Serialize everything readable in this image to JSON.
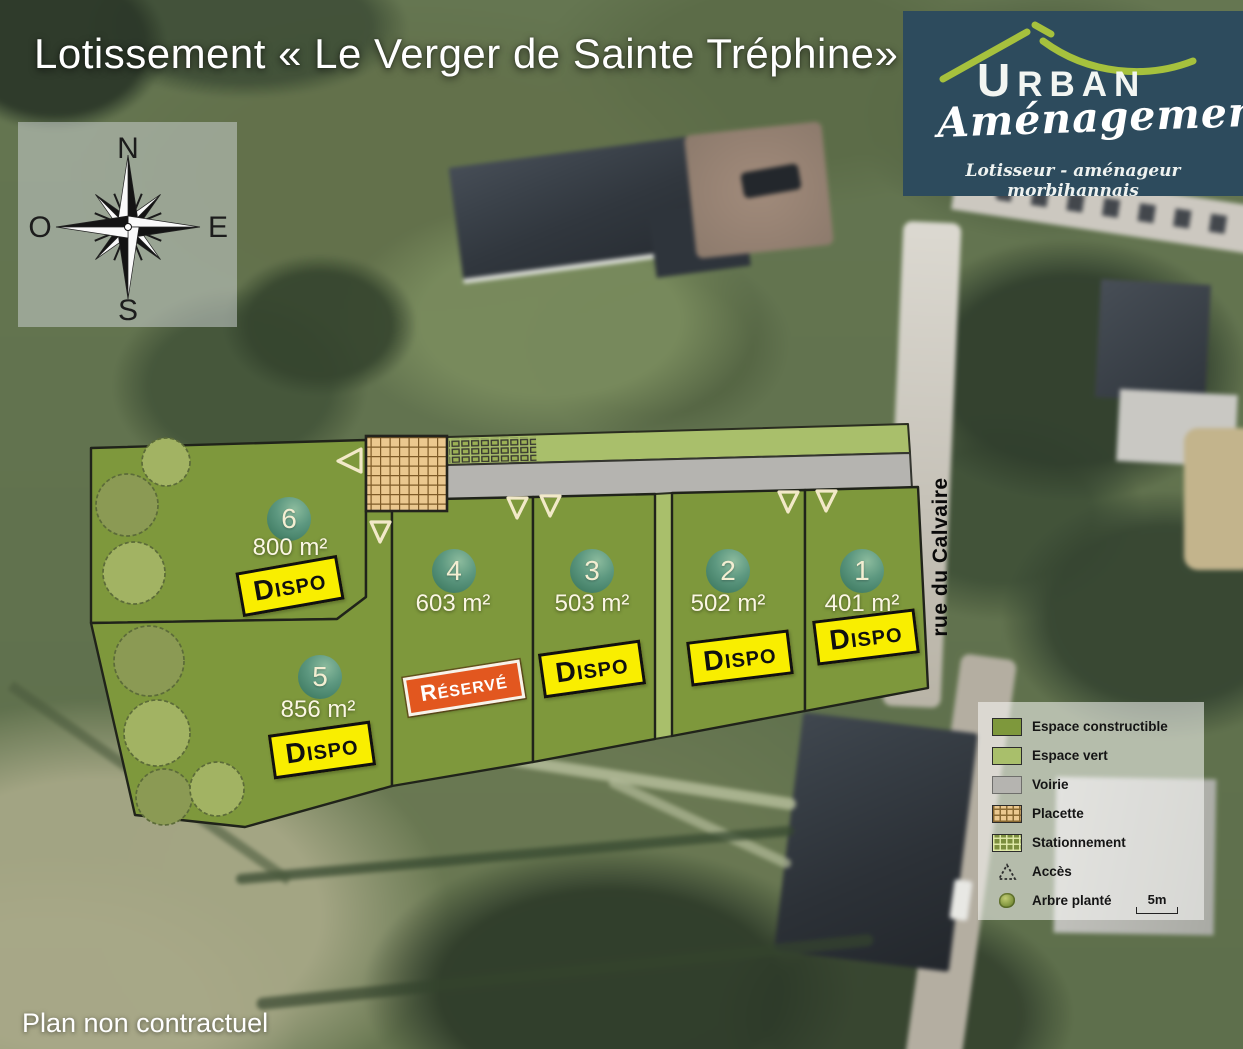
{
  "title": "Lotissement « Le Verger de Sainte Tréphine»",
  "footer": "Plan non contractuel",
  "logo": {
    "brand": "URBAN",
    "brand_sub": "Aménagement",
    "tagline": "Lotisseur - aménageur morbihannais"
  },
  "compass": {
    "n": "N",
    "s": "S",
    "e": "E",
    "w": "O"
  },
  "street": {
    "name": "rue du Calvaire"
  },
  "plots": [
    {
      "number": "1",
      "area": "401 m²",
      "status": "DISPO",
      "status_type": "available"
    },
    {
      "number": "2",
      "area": "502 m²",
      "status": "DISPO",
      "status_type": "available"
    },
    {
      "number": "3",
      "area": "503 m²",
      "status": "DISPO",
      "status_type": "available"
    },
    {
      "number": "4",
      "area": "603 m²",
      "status": "RÉSERVÉ",
      "status_type": "reserved"
    },
    {
      "number": "5",
      "area": "856 m²",
      "status": "DISPO",
      "status_type": "available"
    },
    {
      "number": "6",
      "area": "800 m²",
      "status": "DISPO",
      "status_type": "available"
    }
  ],
  "legend": {
    "items": [
      {
        "key": "constructible",
        "label": "Espace constructible"
      },
      {
        "key": "vert",
        "label": "Espace vert"
      },
      {
        "key": "voirie",
        "label": "Voirie"
      },
      {
        "key": "placette",
        "label": "Placette"
      },
      {
        "key": "stationnement",
        "label": "Stationnement"
      },
      {
        "key": "acces",
        "label": "Accès"
      },
      {
        "key": "arbre",
        "label": "Arbre planté"
      }
    ],
    "scale_label": "5m"
  },
  "colors": {
    "constructible": "#7e983c",
    "espace_vert": "#a9bf6b",
    "voirie": "#b5b4b0",
    "placette": "#ebc88f",
    "placette_line": "#7d5a27",
    "outline": "#20231a",
    "dispo_bg": "#f9ee00",
    "reserve_bg": "#e2571f",
    "logo_bg": "#2d4b5d",
    "logo_roof": "#a6c13d"
  }
}
